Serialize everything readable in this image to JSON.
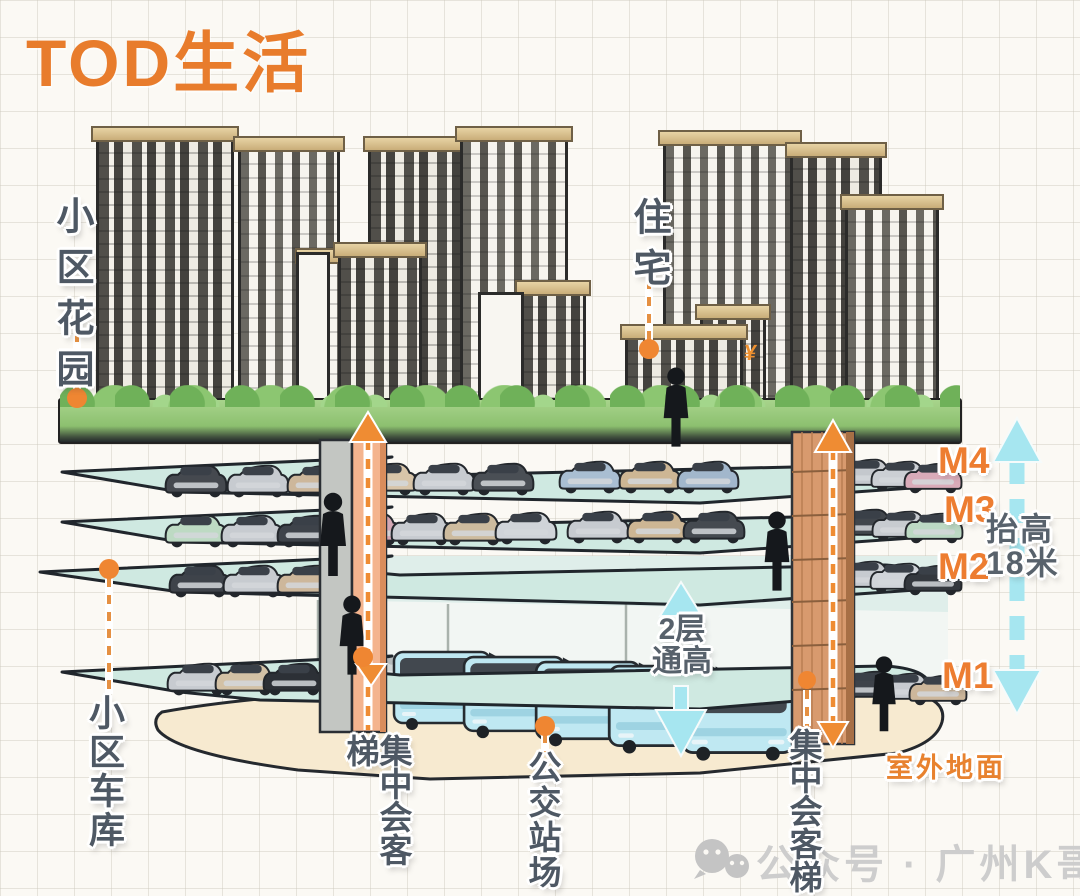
{
  "title": "TOD生活",
  "callouts": {
    "garden": "小区花园",
    "residence": "住宅",
    "garage": "小区车库",
    "elevator_left": "集中会客梯",
    "bus_station": "公交站场",
    "elevator_right": "集中会客梯",
    "outdoor_ground": "室外地面"
  },
  "levels": {
    "m1": "M1",
    "m2": "M2",
    "m3": "M3",
    "m4": "M4"
  },
  "measurements": {
    "raise_line1": "抬高",
    "raise_line2": "18米",
    "double_height_line1": "2层",
    "double_height_line2": "通高"
  },
  "watermark": {
    "icon": "wechat-icon",
    "text": "公众号 · 广州K哥说房"
  },
  "logo_mark": "¥",
  "colors": {
    "accent_orange": "#e87c2c",
    "callout_orange": "#ef8c33",
    "label_slate": "#4e5864",
    "arrow_cyan": "#a6e6f0",
    "deck_teal": "#cfe9e1",
    "ground_cream": "#f7ead0",
    "tower_wood": "#d89a6e",
    "watermark_gray": "#cdcdcd"
  }
}
